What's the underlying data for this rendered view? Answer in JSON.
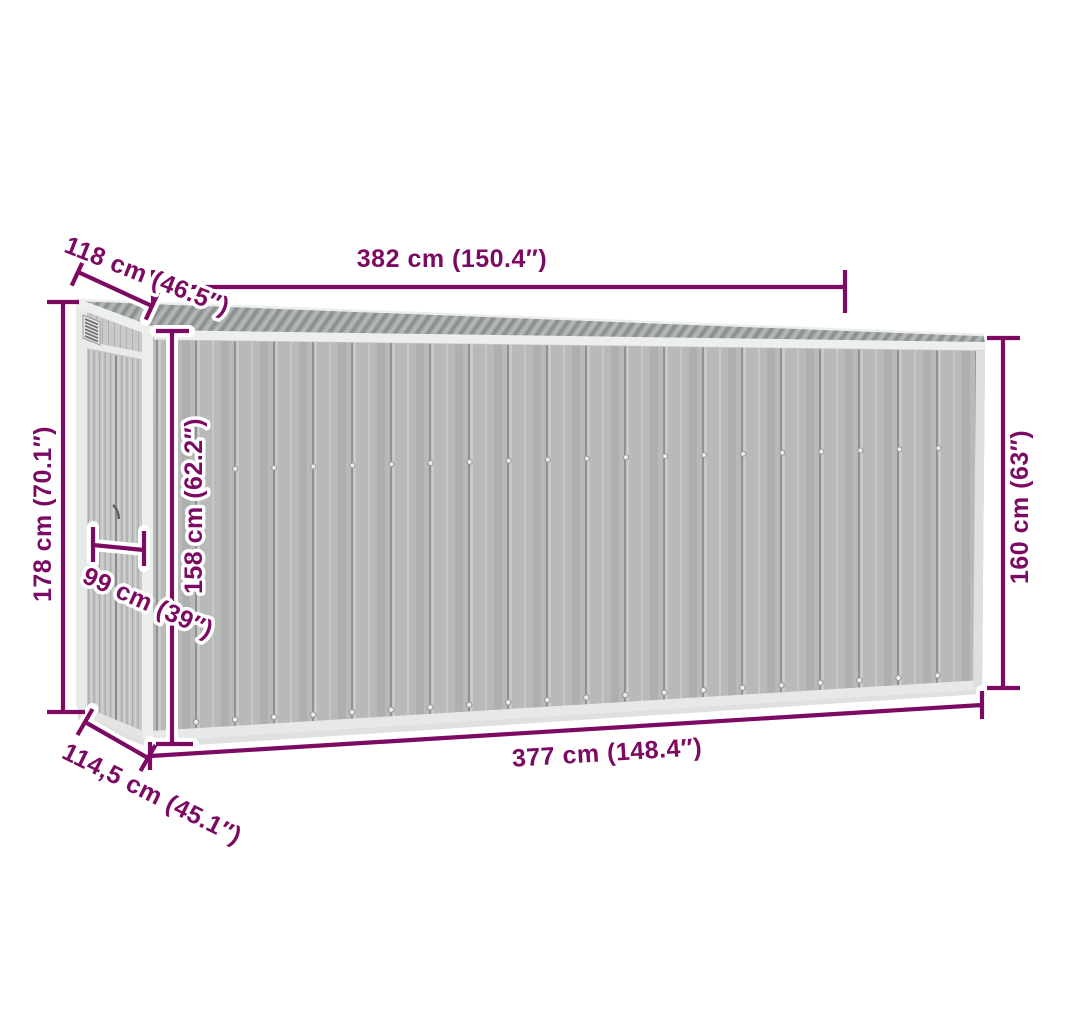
{
  "colors": {
    "accent": "#7C0A63",
    "background": "#FFFFFF",
    "wall_gray": "#B8BAB9",
    "door_gray": "#C4C6C5",
    "roof_gray": "#A7ABAC",
    "trim_white": "#EDEFEE"
  },
  "diagram": {
    "subject": "garden-shed-dimension-diagram"
  },
  "dimensions": {
    "roof_length": "382 cm (150.4″)",
    "roof_depth": "118 cm (46.5″)",
    "back_height": "178 cm (70.1″)",
    "door_width": "99 cm (39″)",
    "front_left_height": "158 cm (62.2″)",
    "front_right_height": "160 cm (63″)",
    "base_length": "377 cm (148.4″)",
    "base_depth": "114,5 cm (45.1″)"
  }
}
